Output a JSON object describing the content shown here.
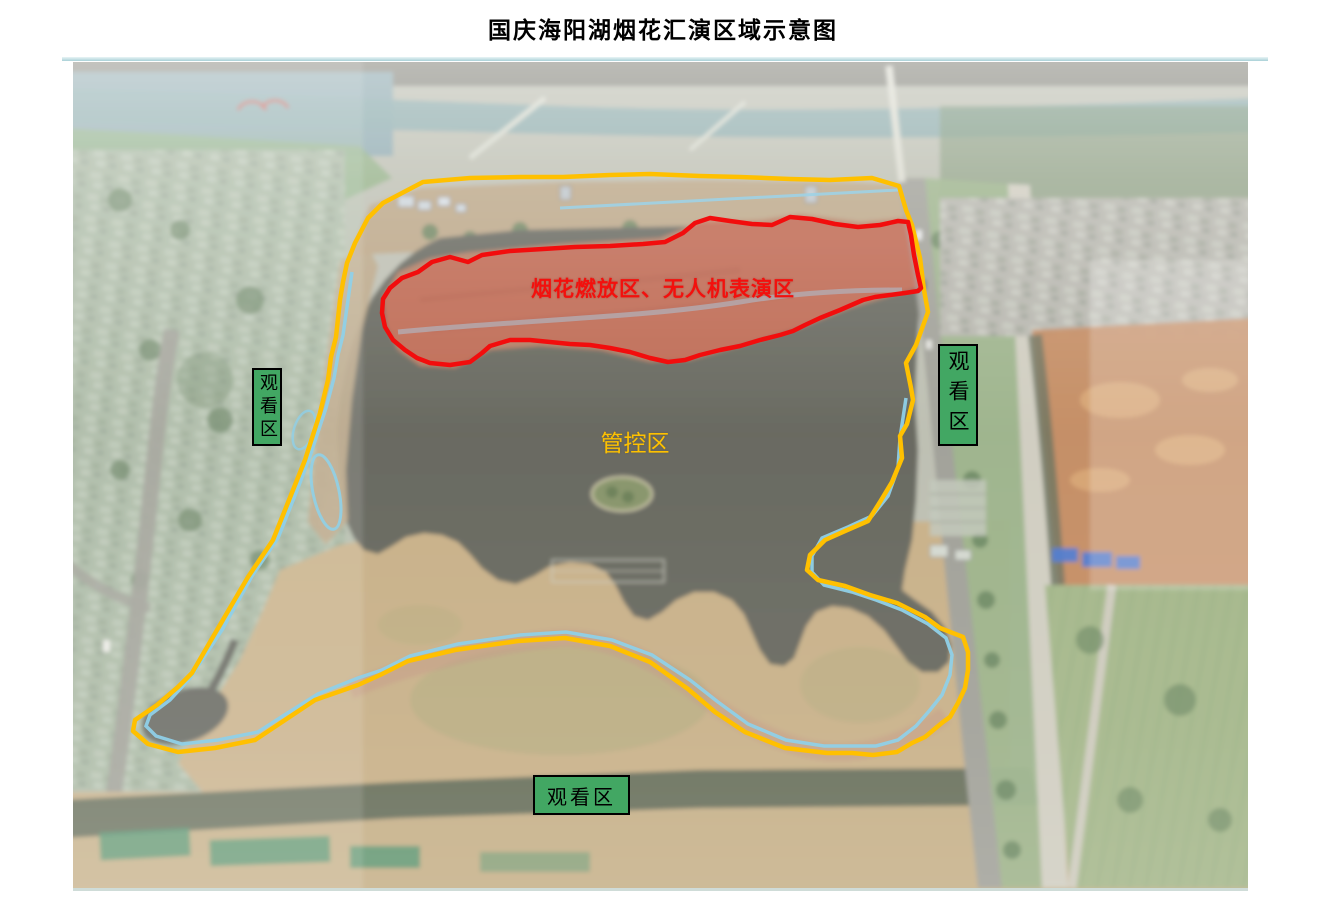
{
  "title": "国庆海阳湖烟花汇演区域示意图",
  "divider_color": "#a9d1d7",
  "zones": {
    "fireworks_zone": {
      "label": "烟花燃放区、无人机表演区",
      "outline_color": "#f20d0d",
      "label_color": "#f3100d"
    },
    "control_zone": {
      "label": "管控区",
      "outline_color": "#ffc000",
      "label_color": "#fec100"
    },
    "viewing_zones": {
      "box_fill": "#42a763",
      "box_border": "#000000",
      "areas": [
        {
          "position": "left",
          "label": "观看区"
        },
        {
          "position": "right",
          "label": "观看区"
        },
        {
          "position": "bottom",
          "label": "观看区"
        }
      ]
    }
  }
}
